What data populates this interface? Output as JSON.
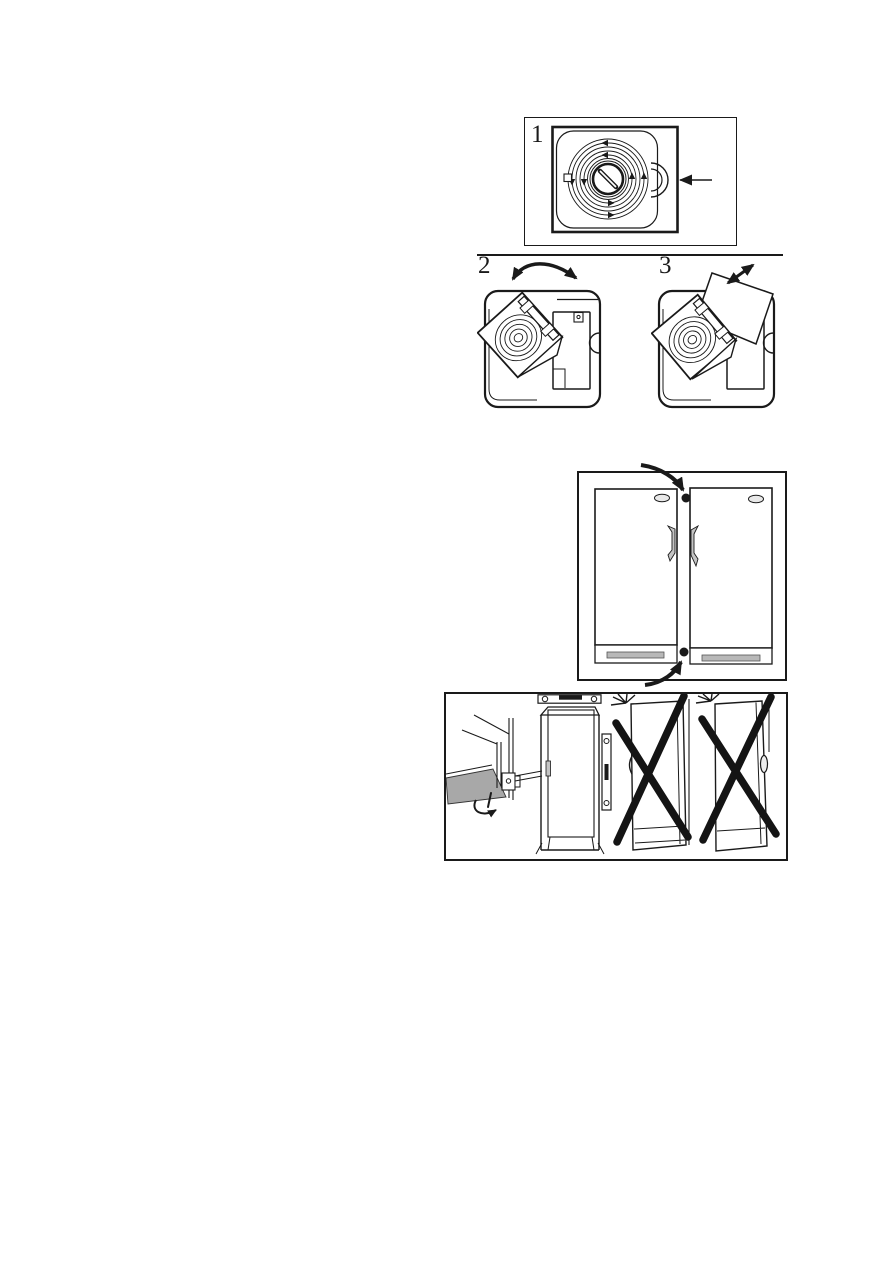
{
  "page": {
    "background": "#ffffff",
    "ink": "#1a1a1a",
    "shade_gray": "#a8a8a8",
    "metal_gray": "#c4c4c4"
  },
  "figures": {
    "step1": {
      "label": "1",
      "illustration": "coil-cover-with-grip-tab-and-pointer-arrow"
    },
    "step2": {
      "label": "2",
      "illustration": "cover-panel-swung-open-rotate-arrow"
    },
    "step3": {
      "label": "3",
      "illustration": "cover-panel-lifted-off-pull-arrow"
    },
    "clearance": {
      "illustration": "two-upright-cabinets-side-by-side-with-spacer-dots"
    },
    "installation": {
      "illustration": "upright-cabinet-wall-mounting-correct-and-two-crossed-out-wrong-ways"
    }
  }
}
